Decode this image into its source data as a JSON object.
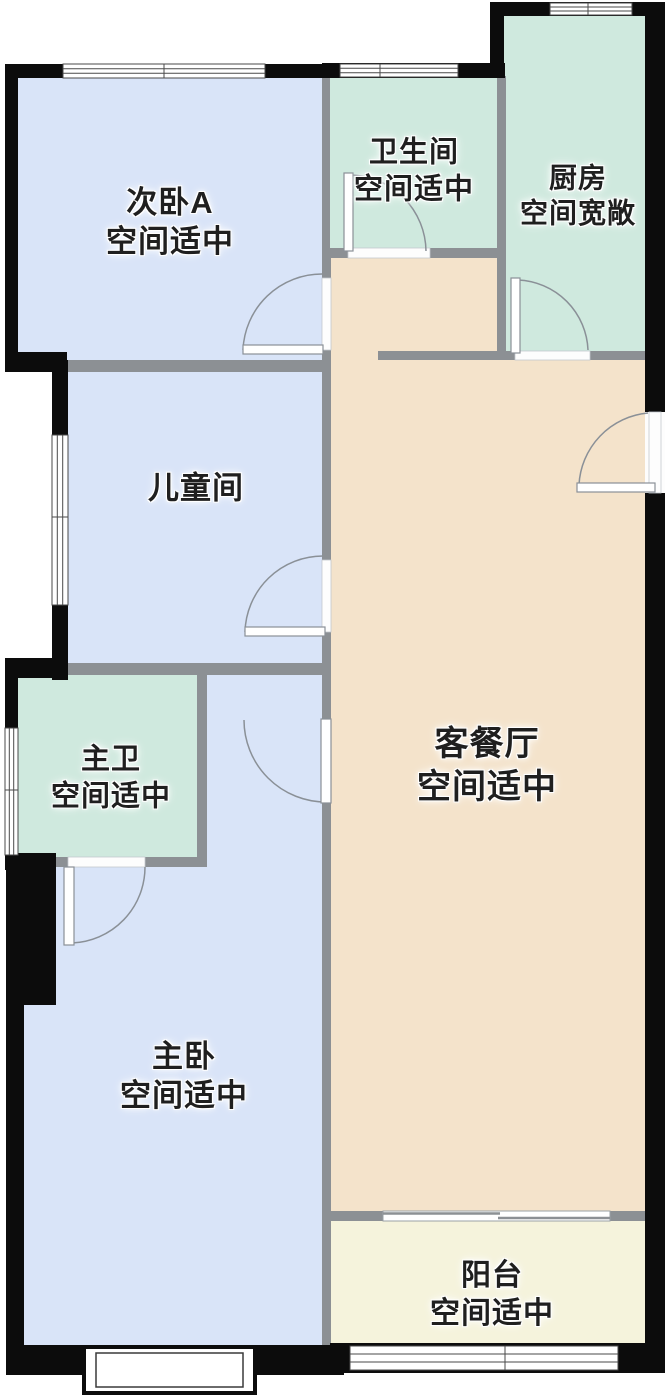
{
  "floorplan": {
    "rooms": {
      "secondary_bedroom_a": {
        "name": "次卧A",
        "note": "空间适中"
      },
      "bathroom": {
        "name": "卫生间",
        "note": "空间适中"
      },
      "kitchen": {
        "name": "厨房",
        "note": "空间宽敞"
      },
      "children_room": {
        "name": "儿童间",
        "note": ""
      },
      "master_bathroom": {
        "name": "主卫",
        "note": "空间适中"
      },
      "living_dining": {
        "name": "客餐厅",
        "note": "空间适中"
      },
      "master_bedroom": {
        "name": "主卧",
        "note": "空间适中"
      },
      "balcony": {
        "name": "阳台",
        "note": "空间适中"
      }
    },
    "colors": {
      "bedroom_fill": "#d9e4f8",
      "wet_room_fill": "#cfe9de",
      "living_fill": "#f4e3cb",
      "balcony_fill": "#f5f3dc",
      "interior_wall": "#8c9094",
      "exterior_wall": "#0c0c0c",
      "label_text": "#1f1f1f"
    }
  }
}
